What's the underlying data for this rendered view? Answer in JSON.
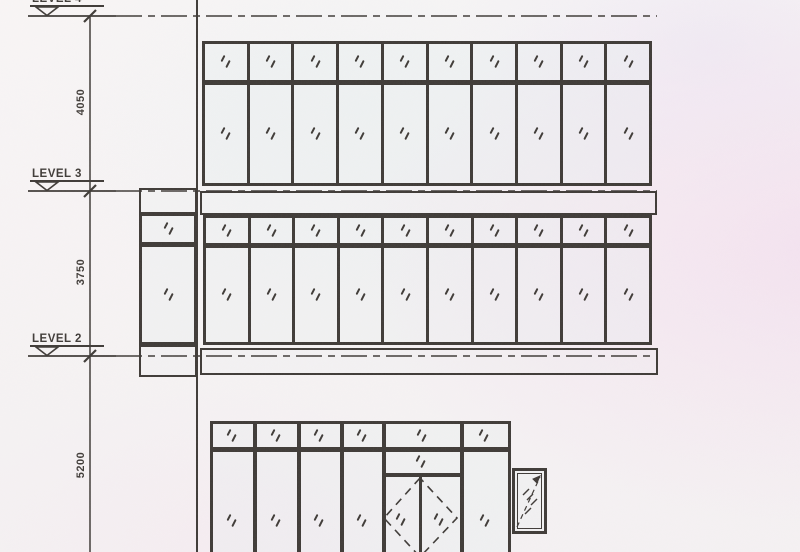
{
  "drawing": {
    "sheet_type": "building-elevation-scan",
    "ink_color": "#3f3b37",
    "paper_color": "#f6f3f3",
    "levels": [
      {
        "label": "LEVEL 4",
        "y": 16,
        "label_clipped": true
      },
      {
        "label": "LEVEL 3",
        "y": 191,
        "label_clipped": false
      },
      {
        "label": "LEVEL 2",
        "y": 356,
        "label_clipped": false
      }
    ],
    "level_line": {
      "solid_x1": 28,
      "solid_x2": 116,
      "dash_x2": 657
    },
    "dimension_axis": {
      "x": 90,
      "y1": 16,
      "y2": 552
    },
    "dimensions": [
      {
        "value": "4050",
        "center_y": 103
      },
      {
        "value": "3750",
        "center_y": 273
      },
      {
        "value": "5200",
        "center_y": 466
      }
    ],
    "grid_edge_line": {
      "x": 197,
      "y1": 0,
      "y2": 552
    },
    "window_bands": [
      {
        "name": "upper-window-band",
        "x": 202,
        "y": 41,
        "w": 450,
        "h": 145,
        "transom_row": 41,
        "cols": 10
      },
      {
        "name": "middle-window-band",
        "x": 203,
        "y": 215,
        "w": 449,
        "h": 130,
        "transom_row": 30,
        "cols": 10
      },
      {
        "name": "middle-band-left-return",
        "x": 139,
        "y": 213,
        "w": 58,
        "h": 132,
        "transom_row": 31,
        "cols": 1
      }
    ],
    "spandrels": [
      {
        "name": "left-return-top-spandrel",
        "x": 139,
        "y": 188,
        "w": 58,
        "h": 26
      },
      {
        "name": "level3-spandrel",
        "x": 200,
        "y": 191,
        "w": 457,
        "h": 24
      },
      {
        "name": "left-return-bottom-spandrel",
        "x": 139,
        "y": 345,
        "w": 58,
        "h": 32
      },
      {
        "name": "level2-spandrel",
        "x": 200,
        "y": 348,
        "w": 458,
        "h": 27
      }
    ],
    "storefront": {
      "x": 210,
      "y": 421,
      "w": 301,
      "h": 131,
      "frame": 3,
      "rail": {
        "y": 447,
        "h": 5
      },
      "mullions_x": [
        253,
        297,
        340,
        382,
        460
      ],
      "transom_glass": [
        [
          231,
          436
        ],
        [
          275,
          436
        ],
        [
          318,
          436
        ],
        [
          361,
          436
        ],
        [
          421,
          436
        ],
        [
          483,
          436
        ]
      ],
      "tall_glass": [
        [
          231,
          521
        ],
        [
          275,
          521
        ],
        [
          318,
          521
        ],
        [
          361,
          521
        ],
        [
          484,
          521
        ]
      ],
      "door": {
        "jamb_left": 382,
        "jamb_right": 460,
        "transom_glass": [
          420,
          462
        ],
        "head_rail": {
          "y": 473,
          "h": 4
        },
        "stile_x": 418.5,
        "leaf_glass": [
          [
            400,
            520
          ],
          [
            438,
            520
          ]
        ],
        "swing_diamond": [
          [
            420,
            478
          ],
          [
            384,
            518
          ],
          [
            420,
            557
          ],
          [
            457,
            518
          ]
        ]
      }
    },
    "small_window": {
      "x": 512,
      "y": 468,
      "w": 35,
      "h": 66,
      "hatch": [
        [
          526,
          492
        ],
        [
          530,
          497
        ],
        [
          534,
          502
        ],
        [
          528,
          511
        ]
      ],
      "opening_arrow": {
        "from": [
          517,
          527
        ],
        "to": [
          540,
          477
        ]
      }
    },
    "symbols": {
      "glass": "double-slash-glazing-mark",
      "level_datum": "open-triangle-datum",
      "dimension_tick": "oblique-tick"
    }
  }
}
